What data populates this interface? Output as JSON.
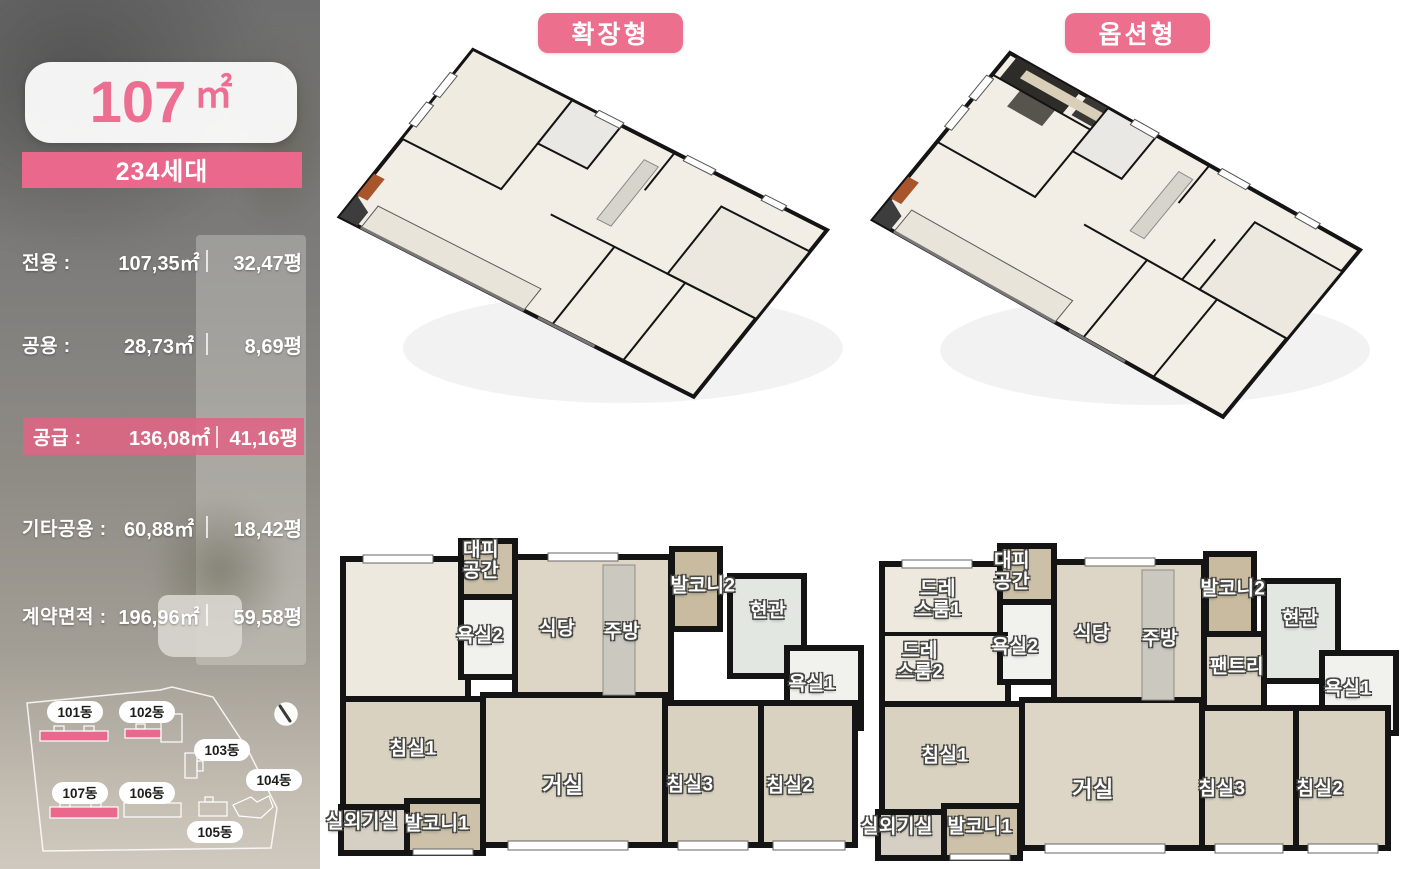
{
  "sidebar": {
    "area_number": "107",
    "area_unit": "㎡",
    "units_badge": "234세대",
    "rows": [
      {
        "label": "전용 :",
        "sqm": "107,35㎡",
        "pyeong": "32,47평"
      },
      {
        "label": "공용 :",
        "sqm": "28,73㎡",
        "pyeong": "8,69평"
      },
      {
        "label": "공급 :",
        "sqm": "136,08㎡",
        "pyeong": "41,16평"
      },
      {
        "label": "기타공용 :",
        "sqm": "60,88㎡",
        "pyeong": "18,42평"
      },
      {
        "label": "계약면적 :",
        "sqm": "196,96㎡",
        "pyeong": "59,58평"
      }
    ],
    "site_plan": {
      "buildings": [
        {
          "name": "101동",
          "highlighted": true
        },
        {
          "name": "102동",
          "highlighted": true
        },
        {
          "name": "103동",
          "highlighted": false
        },
        {
          "name": "104동",
          "highlighted": false
        },
        {
          "name": "105동",
          "highlighted": false
        },
        {
          "name": "106동",
          "highlighted": false
        },
        {
          "name": "107동",
          "highlighted": true
        }
      ],
      "compass_icon": "compass-needle"
    }
  },
  "plans": {
    "extended": {
      "badge": "확장형",
      "rooms": [
        "대피 공간",
        "발코니2",
        "현관",
        "욕실2",
        "식당",
        "주방",
        "욕실1",
        "침실1",
        "거실",
        "침실3",
        "침실2",
        "실외기실",
        "발코니1"
      ]
    },
    "option": {
      "badge": "옵션형",
      "rooms": [
        "드레 스룸1",
        "대피 공간",
        "발코니2",
        "현관",
        "드레 스룸2",
        "욕실2",
        "식당",
        "주방",
        "팬트리",
        "욕실1",
        "침실1",
        "거실",
        "침실3",
        "침실2",
        "실외기실",
        "발코니1"
      ]
    }
  },
  "colors": {
    "accent_pink": "#E9688C",
    "wall_black": "#141414",
    "floor_beige": "#DDD6C6",
    "balcony_tan": "#C8BB9F"
  }
}
